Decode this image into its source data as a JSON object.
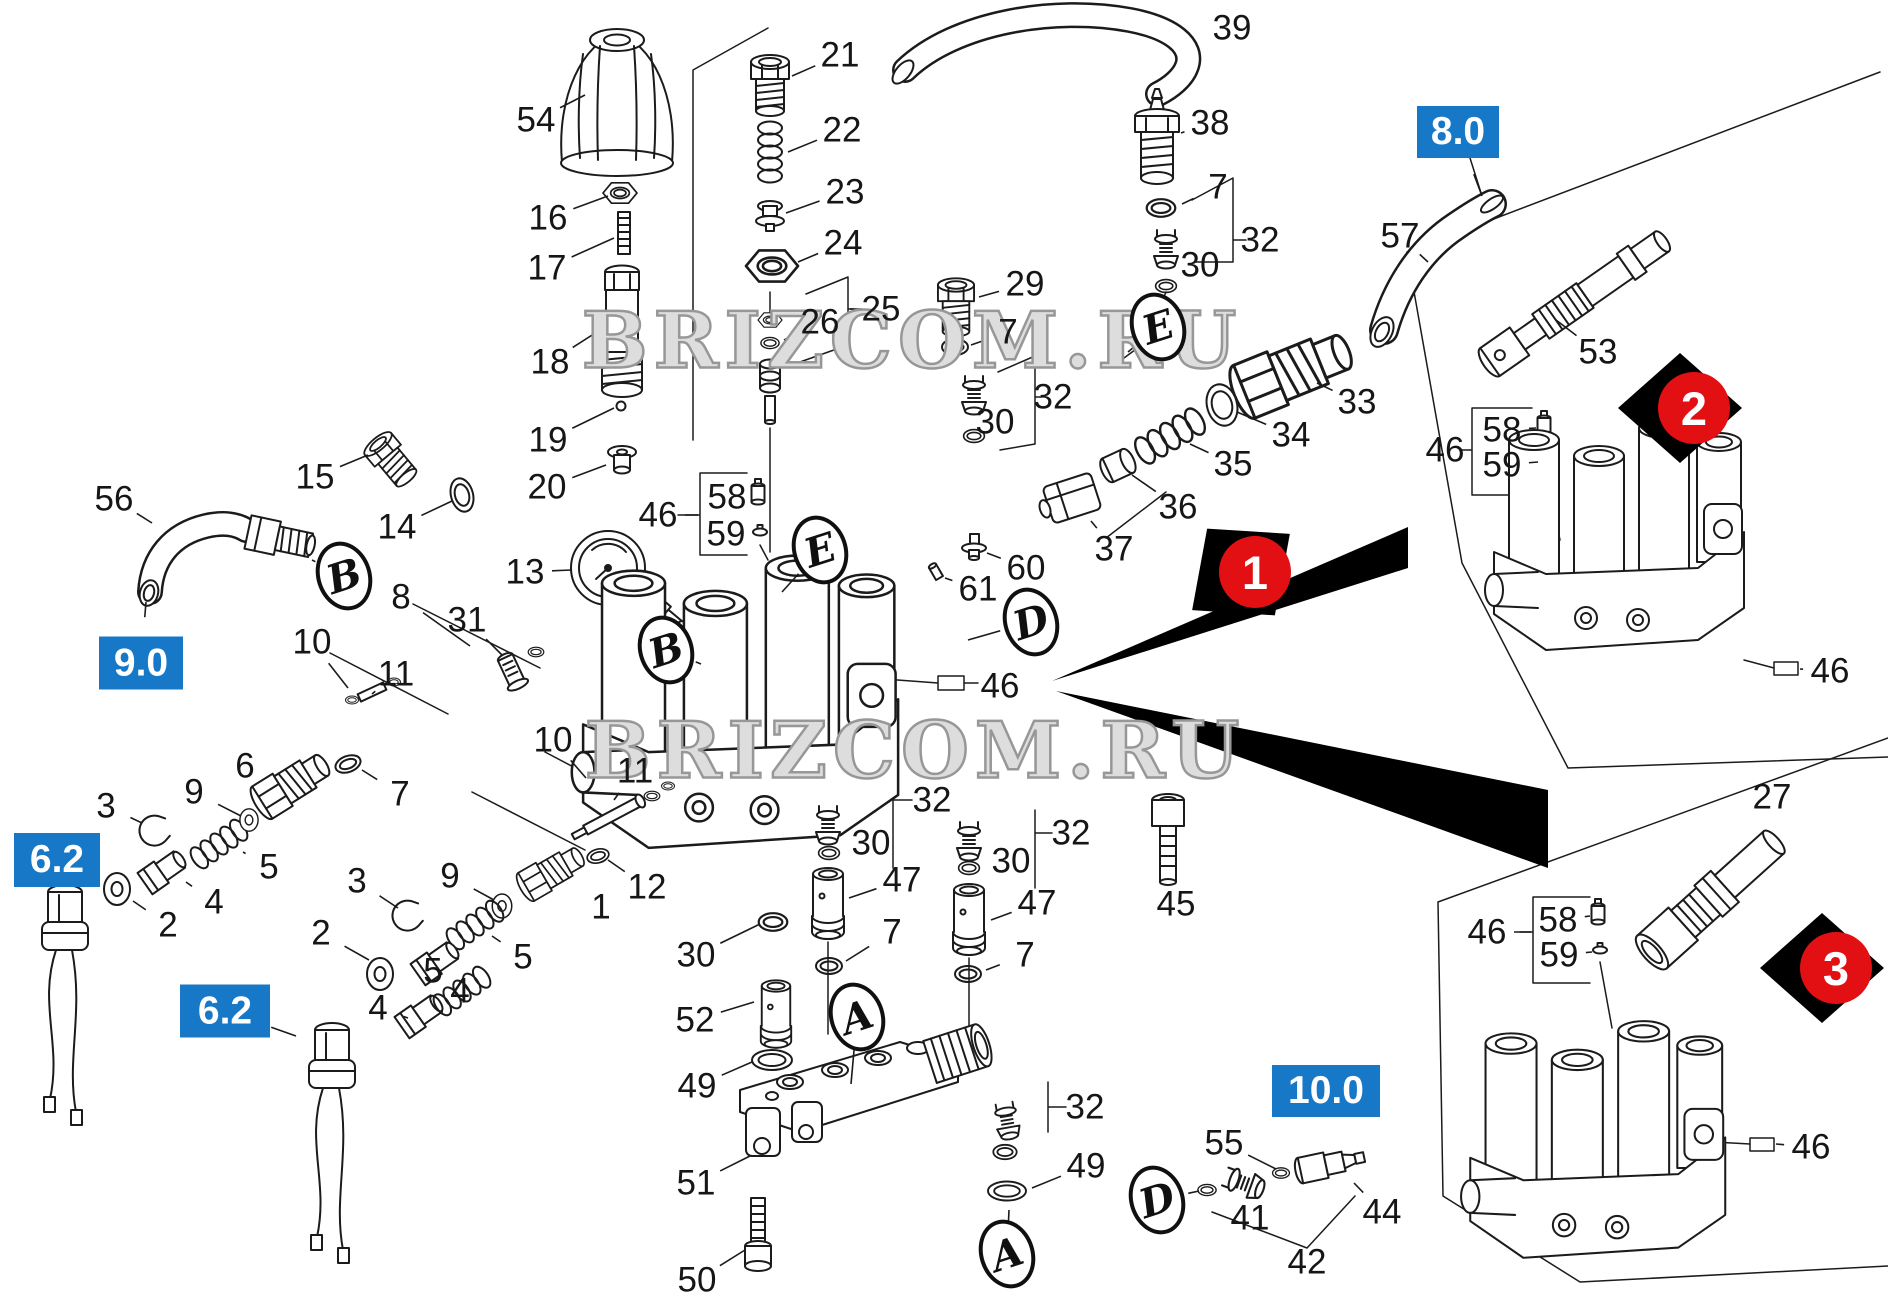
{
  "watermark": {
    "text": "BRIZCOM.RU"
  },
  "colors": {
    "accent_blue": "#1878c8",
    "marker_red": "#e31013",
    "line": "#1b1b1b",
    "background": "#ffffff"
  },
  "part_callouts": [
    {
      "text": "54",
      "x": 536,
      "y": 120,
      "tx": 585,
      "ty": 95
    },
    {
      "text": "16",
      "x": 548,
      "y": 218,
      "tx": 608,
      "ty": 196
    },
    {
      "text": "17",
      "x": 547,
      "y": 268,
      "tx": 614,
      "ty": 238
    },
    {
      "text": "18",
      "x": 550,
      "y": 362,
      "tx": 600,
      "ty": 330
    },
    {
      "text": "19",
      "x": 548,
      "y": 440,
      "tx": 614,
      "ty": 408
    },
    {
      "text": "20",
      "x": 547,
      "y": 487,
      "tx": 606,
      "ty": 465
    },
    {
      "text": "21",
      "x": 840,
      "y": 55,
      "tx": 792,
      "ty": 76
    },
    {
      "text": "22",
      "x": 842,
      "y": 130,
      "tx": 788,
      "ty": 152
    },
    {
      "text": "23",
      "x": 845,
      "y": 192,
      "tx": 786,
      "ty": 213
    },
    {
      "text": "24",
      "x": 843,
      "y": 243,
      "tx": 798,
      "ty": 262
    },
    {
      "text": "25",
      "x": 881,
      "y": 309,
      "tx": 850,
      "ty": 309
    },
    {
      "text": "26",
      "x": 820,
      "y": 322,
      "tx": 784,
      "ty": 340
    },
    {
      "text": "29",
      "x": 1025,
      "y": 284,
      "tx": 979,
      "ty": 297
    },
    {
      "text": "7",
      "x": 1008,
      "y": 332,
      "tx": 971,
      "ty": 345
    },
    {
      "text": "32",
      "x": 1053,
      "y": 397,
      "tx": 1037,
      "ty": 397
    },
    {
      "text": "30",
      "x": 995,
      "y": 422,
      "tx": 977,
      "ty": 410
    },
    {
      "text": "39",
      "x": 1232,
      "y": 28,
      "tx": 1206,
      "ty": 33
    },
    {
      "text": "38",
      "x": 1210,
      "y": 123,
      "tx": 1181,
      "ty": 133
    },
    {
      "text": "7",
      "x": 1218,
      "y": 187,
      "tx": 1182,
      "ty": 204
    },
    {
      "text": "32",
      "x": 1260,
      "y": 240,
      "tx": 1236,
      "ty": 240
    },
    {
      "text": "30",
      "x": 1200,
      "y": 265,
      "tx": 1185,
      "ty": 255
    },
    {
      "text": "57",
      "x": 1400,
      "y": 236,
      "tx": 1428,
      "ty": 262
    },
    {
      "text": "33",
      "x": 1357,
      "y": 402,
      "tx": 1317,
      "ty": 383
    },
    {
      "text": "34",
      "x": 1291,
      "y": 435,
      "tx": 1237,
      "ty": 412
    },
    {
      "text": "35",
      "x": 1233,
      "y": 464,
      "tx": 1190,
      "ty": 444
    },
    {
      "text": "36",
      "x": 1178,
      "y": 507,
      "tx": 1132,
      "ty": 475
    },
    {
      "text": "37",
      "x": 1114,
      "y": 549,
      "tx": 1091,
      "ty": 521
    },
    {
      "text": "60",
      "x": 1026,
      "y": 568,
      "tx": 987,
      "ty": 553
    },
    {
      "text": "61",
      "x": 978,
      "y": 589,
      "tx": 945,
      "ty": 578
    },
    {
      "text": "53",
      "x": 1598,
      "y": 352,
      "tx": 1556,
      "ty": 320
    },
    {
      "text": "46",
      "x": 1445,
      "y": 450,
      "tx": 1470,
      "ty": 450
    },
    {
      "text": "58",
      "x": 1502,
      "y": 430,
      "tx": 1536,
      "ty": 428
    },
    {
      "text": "59",
      "x": 1502,
      "y": 465,
      "tx": 1538,
      "ty": 462
    },
    {
      "text": "46",
      "x": 1830,
      "y": 671,
      "tx": 1800,
      "ty": 669
    },
    {
      "text": "27",
      "x": 1772,
      "y": 797,
      "tx": 1766,
      "ty": 824
    },
    {
      "text": "46",
      "x": 1487,
      "y": 932,
      "tx": 1531,
      "ty": 932
    },
    {
      "text": "58",
      "x": 1558,
      "y": 920,
      "tx": 1590,
      "ty": 916
    },
    {
      "text": "59",
      "x": 1559,
      "y": 955,
      "tx": 1592,
      "ty": 952
    },
    {
      "text": "46",
      "x": 1811,
      "y": 1147,
      "tx": 1776,
      "ty": 1144
    },
    {
      "text": "56",
      "x": 114,
      "y": 499,
      "tx": 152,
      "ty": 523
    },
    {
      "text": "15",
      "x": 315,
      "y": 477,
      "tx": 368,
      "ty": 455
    },
    {
      "text": "14",
      "x": 397,
      "y": 527,
      "tx": 452,
      "ty": 501
    },
    {
      "text": "13",
      "x": 525,
      "y": 572,
      "tx": 571,
      "ty": 570
    },
    {
      "text": "8",
      "x": 401,
      "y": 597,
      "tx": 470,
      "ty": 646
    },
    {
      "text": "31",
      "x": 467,
      "y": 620,
      "tx": 502,
      "ty": 655
    },
    {
      "text": "10",
      "x": 312,
      "y": 642,
      "tx": 348,
      "ty": 688
    },
    {
      "text": "11",
      "x": 396,
      "y": 674,
      "tx": 372,
      "ty": 694
    },
    {
      "text": "46",
      "x": 658,
      "y": 515,
      "tx": 698,
      "ty": 515
    },
    {
      "text": "58",
      "x": 727,
      "y": 497,
      "tx": 750,
      "ty": 493
    },
    {
      "text": "59",
      "x": 726,
      "y": 534,
      "tx": 752,
      "ty": 531
    },
    {
      "text": "6",
      "x": 245,
      "y": 766,
      "tx": 267,
      "ty": 778
    },
    {
      "text": "9",
      "x": 194,
      "y": 792,
      "tx": 241,
      "ty": 816
    },
    {
      "text": "3",
      "x": 106,
      "y": 806,
      "tx": 142,
      "ty": 823
    },
    {
      "text": "7",
      "x": 400,
      "y": 794,
      "tx": 362,
      "ty": 770
    },
    {
      "text": "5",
      "x": 269,
      "y": 867,
      "tx": 243,
      "ty": 852
    },
    {
      "text": "4",
      "x": 214,
      "y": 902,
      "tx": 186,
      "ty": 882
    },
    {
      "text": "2",
      "x": 168,
      "y": 925,
      "tx": 133,
      "ty": 901
    },
    {
      "text": "3",
      "x": 357,
      "y": 881,
      "tx": 398,
      "ty": 908
    },
    {
      "text": "2",
      "x": 321,
      "y": 933,
      "tx": 369,
      "ty": 960
    },
    {
      "text": "4",
      "x": 378,
      "y": 1008,
      "tx": 408,
      "ty": 1018
    },
    {
      "text": "5",
      "x": 433,
      "y": 971,
      "tx": 452,
      "ty": 986
    },
    {
      "text": "10",
      "x": 553,
      "y": 740,
      "tx": 586,
      "ty": 778
    },
    {
      "text": "11",
      "x": 635,
      "y": 771,
      "tx": 614,
      "ty": 800
    },
    {
      "text": "12",
      "x": 647,
      "y": 887,
      "tx": 608,
      "ty": 860
    },
    {
      "text": "1",
      "x": 601,
      "y": 907,
      "tx": 578,
      "ty": 890
    },
    {
      "text": "9",
      "x": 450,
      "y": 876,
      "tx": 494,
      "ty": 900
    },
    {
      "text": "5",
      "x": 523,
      "y": 957,
      "tx": 492,
      "ty": 936
    },
    {
      "text": "4",
      "x": 460,
      "y": 991,
      "tx": 440,
      "ty": 975
    },
    {
      "text": "30",
      "x": 696,
      "y": 955,
      "tx": 760,
      "ty": 924
    },
    {
      "text": "52",
      "x": 695,
      "y": 1020,
      "tx": 754,
      "ty": 1002
    },
    {
      "text": "49",
      "x": 697,
      "y": 1086,
      "tx": 752,
      "ty": 1062
    },
    {
      "text": "51",
      "x": 696,
      "y": 1183,
      "tx": 750,
      "ty": 1156
    },
    {
      "text": "50",
      "x": 697,
      "y": 1280,
      "tx": 745,
      "ty": 1250
    },
    {
      "text": "32",
      "x": 932,
      "y": 800,
      "tx": 908,
      "ty": 800
    },
    {
      "text": "30",
      "x": 871,
      "y": 843,
      "tx": 846,
      "ty": 852
    },
    {
      "text": "47",
      "x": 902,
      "y": 880,
      "tx": 849,
      "ty": 898
    },
    {
      "text": "7",
      "x": 892,
      "y": 932,
      "tx": 846,
      "ty": 961
    },
    {
      "text": "32",
      "x": 1071,
      "y": 833,
      "tx": 1048,
      "ty": 833
    },
    {
      "text": "30",
      "x": 1011,
      "y": 861,
      "tx": 988,
      "ty": 866
    },
    {
      "text": "47",
      "x": 1037,
      "y": 903,
      "tx": 991,
      "ty": 920
    },
    {
      "text": "7",
      "x": 1025,
      "y": 955,
      "tx": 986,
      "ty": 970
    },
    {
      "text": "45",
      "x": 1176,
      "y": 904,
      "tx": 1171,
      "ty": 887
    },
    {
      "text": "46",
      "x": 1000,
      "y": 686,
      "tx": 978,
      "ty": 684
    },
    {
      "text": "32",
      "x": 1085,
      "y": 1107,
      "tx": 1062,
      "ty": 1107
    },
    {
      "text": "49",
      "x": 1086,
      "y": 1166,
      "tx": 1032,
      "ty": 1188
    },
    {
      "text": "55",
      "x": 1224,
      "y": 1143,
      "tx": 1276,
      "ty": 1169
    },
    {
      "text": "41",
      "x": 1250,
      "y": 1218,
      "tx": 1245,
      "ty": 1201
    },
    {
      "text": "42",
      "x": 1307,
      "y": 1262
    },
    {
      "text": "44",
      "x": 1382,
      "y": 1212,
      "tx": 1354,
      "ty": 1183
    }
  ],
  "section_labels": [
    {
      "text": "8.0",
      "x": 1458,
      "y": 132,
      "w": 82,
      "h": 52,
      "tx": 1482,
      "ty": 196
    },
    {
      "text": "9.0",
      "x": 141,
      "y": 663,
      "w": 84,
      "h": 53,
      "tx": 146,
      "ty": 602
    },
    {
      "text": "6.2",
      "x": 57,
      "y": 860,
      "w": 86,
      "h": 54,
      "tx": 60,
      "ty": 894
    },
    {
      "text": "6.2",
      "x": 225,
      "y": 1011,
      "w": 90,
      "h": 53,
      "tx": 296,
      "ty": 1036
    },
    {
      "text": "10.0",
      "x": 1326,
      "y": 1091,
      "w": 108,
      "h": 52,
      "tx": 1329,
      "ty": 1146
    }
  ],
  "view_markers": [
    {
      "text": "1",
      "x": 1255,
      "y": 572,
      "rot": -38
    },
    {
      "text": "2",
      "x": 1694,
      "y": 408,
      "rot": 0
    },
    {
      "text": "3",
      "x": 1836,
      "y": 968,
      "rot": 0
    }
  ],
  "letter_tags": [
    {
      "text": "E",
      "x": 1158,
      "y": 327,
      "tx": 1128,
      "ty": 352
    },
    {
      "text": "E",
      "x": 820,
      "y": 550,
      "tx": 782,
      "ty": 592
    },
    {
      "text": "B",
      "x": 666,
      "y": 650,
      "tx": 701,
      "ty": 664
    },
    {
      "text": "B",
      "x": 344,
      "y": 576,
      "tx": 312,
      "ty": 560
    },
    {
      "text": "D",
      "x": 1031,
      "y": 622,
      "tx": 968,
      "ty": 640
    },
    {
      "text": "D",
      "x": 1157,
      "y": 1200,
      "tx": 1199,
      "ty": 1191
    },
    {
      "text": "A",
      "x": 857,
      "y": 1017,
      "tx": 851,
      "ty": 1084
    },
    {
      "text": "A",
      "x": 1007,
      "y": 1254,
      "tx": 1009,
      "ty": 1210
    }
  ]
}
